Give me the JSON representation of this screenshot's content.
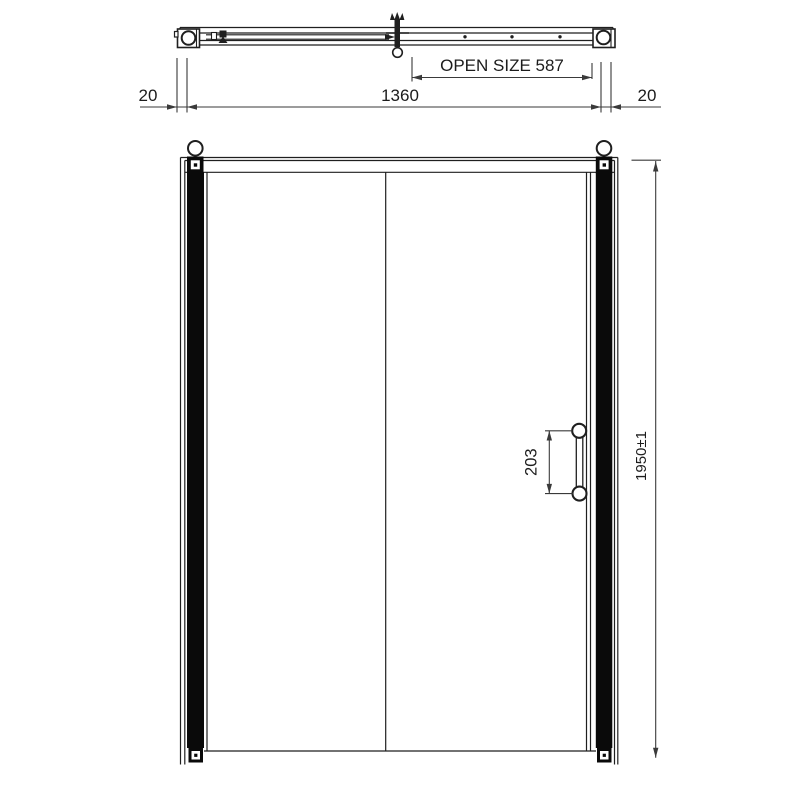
{
  "page": {
    "background_color": "#ffffff",
    "line_color": "#1f1f1f",
    "profile_fill_color": "#0a0a0a"
  },
  "top_view": {
    "open_size_label": "OPEN SIZE 587",
    "left_wall_thickness_label": "20",
    "overall_width_label": "1360",
    "right_wall_thickness_label": "20"
  },
  "elevation": {
    "overall_height_label": "1950±1",
    "handle_centres_label": "203"
  }
}
